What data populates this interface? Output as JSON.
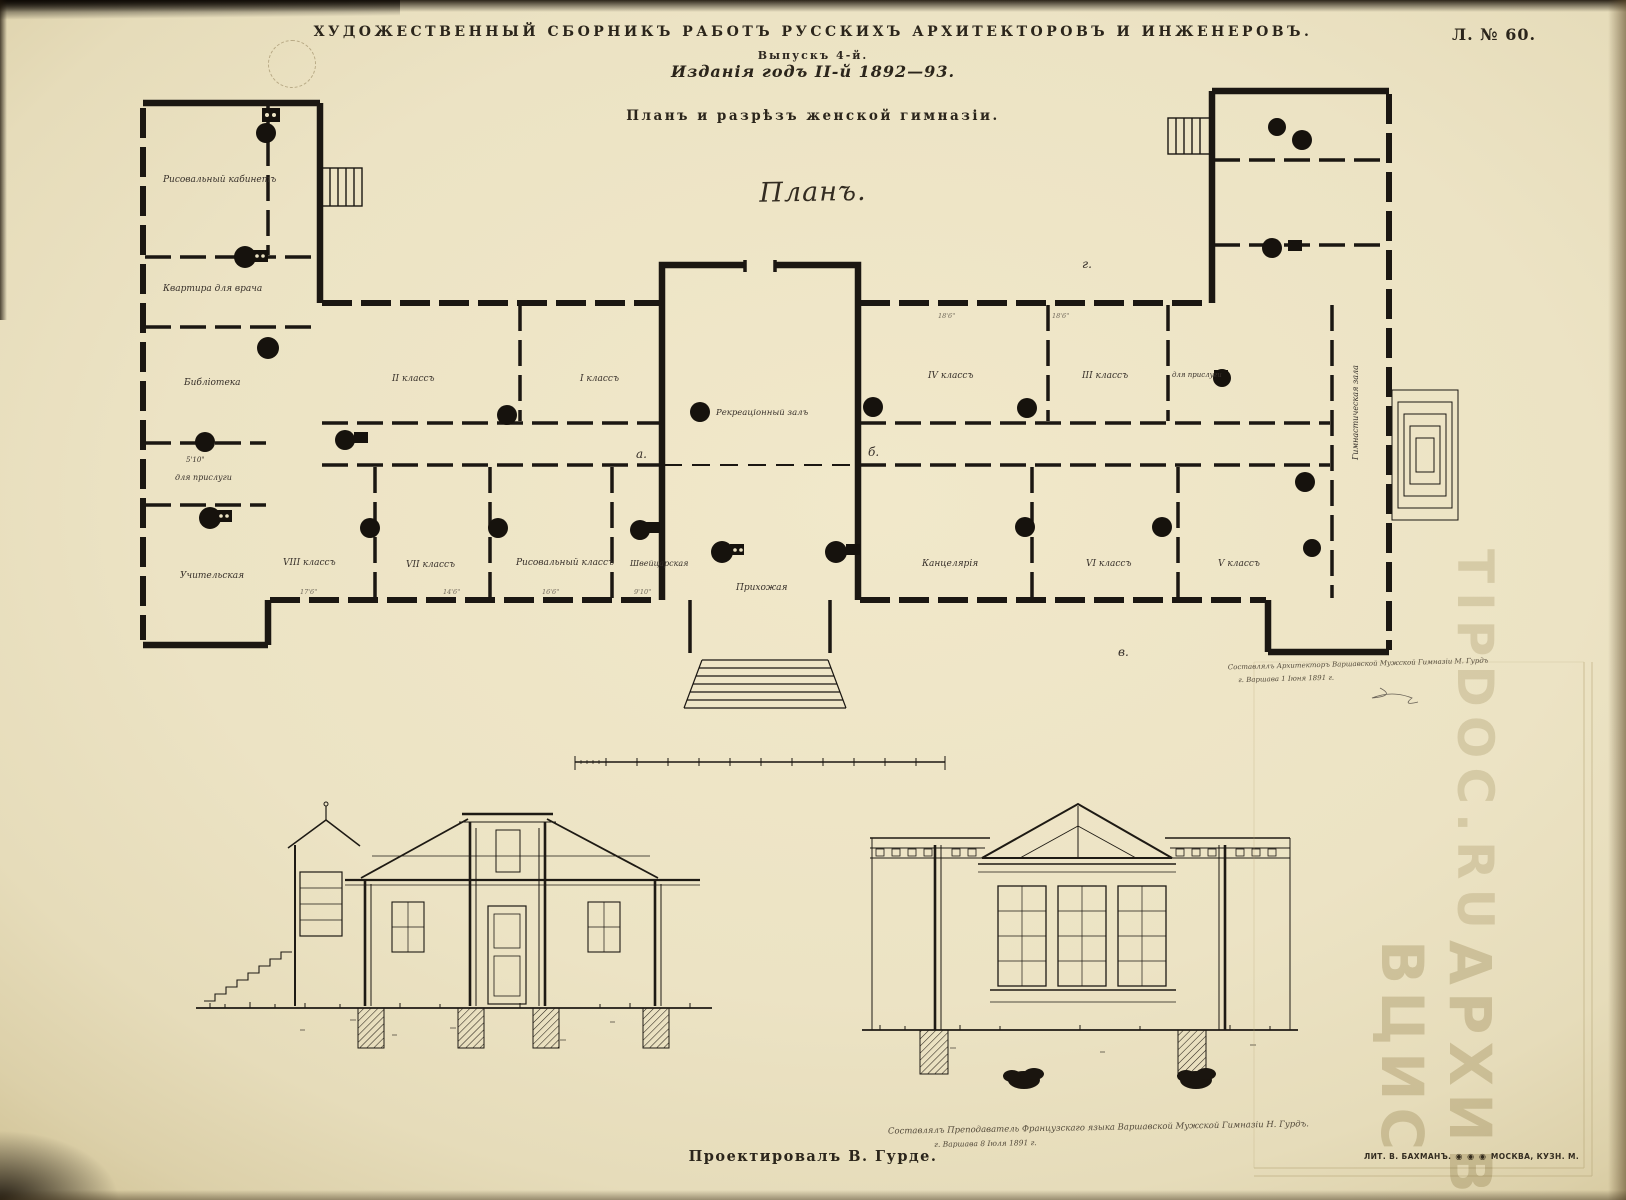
{
  "plate": {
    "series_title": "ХУДОЖЕСТВЕННЫЙ СБОРНИКЪ РАБОТЪ РУССКИХЪ АРХИТЕКТОРОВЪ И ИНЖЕНЕРОВЪ.",
    "issue": "Выпускъ 4-й.",
    "edition_year": "Изданія годъ II-й 1892—93.",
    "sheet_number": "Л. № 60.",
    "title": "Планъ и разрѣзъ женской гимназіи.",
    "plan_caption": "Планъ."
  },
  "plan_labels": {
    "drawing_cabinet": "Рисовальный кабинетъ",
    "doctor_flat": "Квартира для врача",
    "library": "Библіотека",
    "dim_small": "5'10\"",
    "servants_left": "для прислуги",
    "teachers_room": "Учительская",
    "class_2": "II классъ",
    "class_1": "I классъ",
    "recreation_hall": "Рекреаціонный залъ",
    "class_4": "IV классъ",
    "class_3": "III классъ",
    "servants_right": "для прислуги",
    "class_8": "VIII классъ",
    "class_7": "VII классъ",
    "drawing_class": "Рисовальный классъ",
    "porter_room": "Швейцарская",
    "entrance_hall": "Прихожая",
    "chancellery": "Канцелярія",
    "class_6": "VI классъ",
    "class_5": "V классъ",
    "gym_hall": "Гимнастическая зала",
    "marker_a": "а.",
    "marker_b": "б.",
    "marker_v": "в.",
    "marker_g": "г.",
    "dims": {
      "d1": "17'6\"",
      "d2": "14'6\"",
      "d3": "16'6\"",
      "d4": "9'10\"",
      "d5": "18'6\"",
      "d6": "18'6\""
    }
  },
  "annotations": {
    "plan_note_line1": "Составлялъ Архитекторъ Варшавской Мужской Гимназіи М. Гурдъ",
    "plan_note_line2": "г. Варшава 1 Іюня 1891 г.",
    "section_note_line1": "Составлялъ Преподаватель Французскаго языка Варшавской Мужской Гимназіи Н. Гурдъ.",
    "section_note_line2": "г. Варшава 8 Іюля 1891 г."
  },
  "footer": {
    "credit": "Проектировалъ В. Гурде.",
    "lithographer": "ЛИТ. В. БАХМАНЪ.",
    "medals_icon": "◉ ◉ ◉",
    "lithographer_city": "МОСКВА, КУЗН. М."
  },
  "watermark": {
    "line1": "АРХИВ ВЦИС",
    "line2": "TIPDOC.RU"
  },
  "colors": {
    "paper": "#ece3c4",
    "ink": "#1d1914",
    "cursive_ink": "#46403a",
    "watermark": "#c4b88f"
  }
}
